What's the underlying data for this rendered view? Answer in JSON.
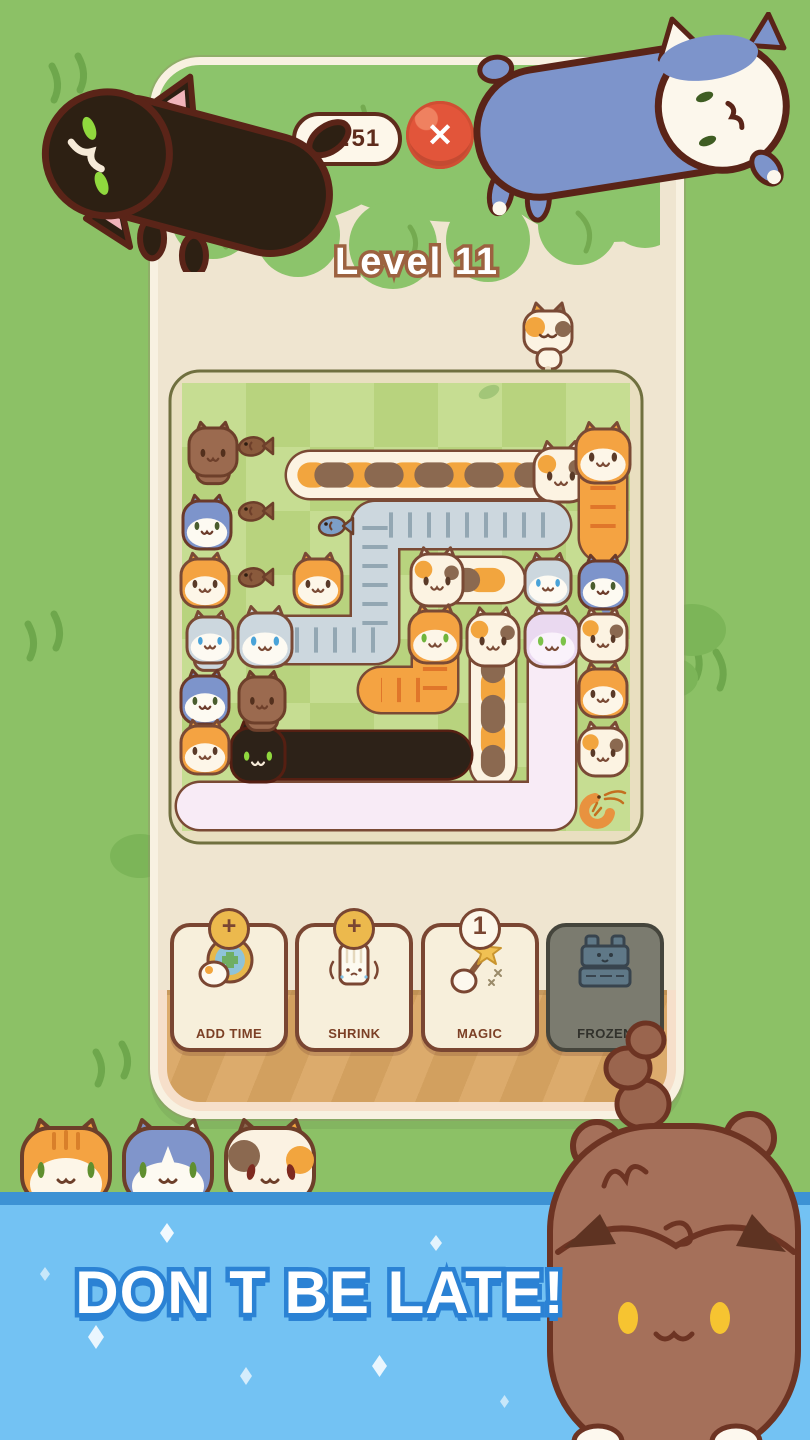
{
  "hud": {
    "timer": "00:51",
    "close": "✕",
    "level": "Level 11"
  },
  "powerups": [
    {
      "label": "ADD TIME",
      "badge": "+",
      "badge_type": "plus"
    },
    {
      "label": "SHRINK",
      "badge": "+",
      "badge_type": "plus"
    },
    {
      "label": "MAGIC",
      "badge": "1",
      "badge_type": "count"
    },
    {
      "label": "FROZEN",
      "badge": "",
      "badge_type": "none"
    }
  ],
  "banner": {
    "text": "DON T BE LATE!"
  },
  "colors": {
    "background": "#8cc166",
    "banner": "#73c2f3",
    "banner_stripe": "#3d92d4",
    "wall": "#efe5d0",
    "wood": "#dcab6c",
    "close_red": "#e2553a",
    "timer_brown": "#5e2c1c",
    "level_outline": "#9c6240",
    "banner_text_outline": "#2b82d4"
  },
  "board": {
    "grid": {
      "cols": 7,
      "rows": 7,
      "cell": 64,
      "origin": 15,
      "light": "#c6dd92",
      "dark": "#b8d37e",
      "frame": "#e9dfc0",
      "frame_edge": "#70703f"
    },
    "palettes": {
      "calico": {
        "base": "#fcf3e2",
        "face": "",
        "patch": [
          "#f2a53e",
          "#8b6950"
        ],
        "eye": "#5a3a28",
        "outline": "#7a4a35",
        "pattern": "spots",
        "spots": true
      },
      "gray": {
        "base": "#ccd7de",
        "face": "#fdfaf2",
        "patch": [
          "#93a7b3"
        ],
        "eye": "#4aa3d8",
        "outline": "#7a4a35",
        "pattern": "ticks"
      },
      "orange": {
        "base": "#f4a342",
        "face": "#fdf6e8",
        "patch": [
          "#e0762a"
        ],
        "eye": "#5a3a28",
        "outline": "#7a4a35",
        "pattern": "ticks"
      },
      "orangeG": {
        "base": "#f4a342",
        "face": "#fdf6e8",
        "patch": [
          "#e0762a"
        ],
        "eye": "#6fb43c",
        "outline": "#7a4a35",
        "pattern": "ticks"
      },
      "husky": {
        "base": "#7d94cb",
        "face": "#fdfaf2",
        "patch": [],
        "eye": "#4a5d2f",
        "outline": "#6b3a2a"
      },
      "brown": {
        "base": "#9b6a4f",
        "face": "",
        "patch": [],
        "eye": "#53301d",
        "outline": "#6d3f2a"
      },
      "black": {
        "base": "#2d2218",
        "face": "",
        "patch": [],
        "eye": "#90d83e",
        "outline": "#551f12"
      },
      "lav": {
        "base": "#ead9f0",
        "face": "#faf2fb",
        "patch": [],
        "eye": "#7cc24a",
        "outline": "#7a4a35",
        "bodyBase": "#f8ebf6"
      }
    },
    "snakes": [
      {
        "name": "calico-long-cat",
        "pal": "calico",
        "w": 46,
        "pts": [
          [
            143,
            107
          ],
          [
            394,
            107
          ]
        ],
        "head": [
          394,
          107
        ]
      },
      {
        "name": "gray-striped-long-cat",
        "pal": "gray",
        "w": 46,
        "pts": [
          [
            98,
            272
          ],
          [
            208,
            272
          ],
          [
            208,
            157
          ],
          [
            380,
            157
          ]
        ],
        "head": [
          98,
          272
        ]
      },
      {
        "name": "orange-long-cat-vertical",
        "pal": "orange",
        "w": 46,
        "pts": [
          [
            436,
            88
          ],
          [
            436,
            170
          ]
        ],
        "head": [
          436,
          88
        ]
      },
      {
        "name": "calico-long-cat-2",
        "pal": "calico",
        "w": 44,
        "pts": [
          [
            270,
            212
          ],
          [
            335,
            212
          ]
        ],
        "head": [
          270,
          212
        ]
      },
      {
        "name": "orange-long-cat-l",
        "pal": "orangeG",
        "w": 44,
        "pts": [
          [
            268,
            269
          ],
          [
            268,
            322
          ],
          [
            214,
            322
          ]
        ],
        "head": [
          268,
          269
        ]
      },
      {
        "name": "calico-long-cat-vertical",
        "pal": "calico",
        "w": 44,
        "pts": [
          [
            326,
            272
          ],
          [
            326,
            397
          ]
        ],
        "head": [
          326,
          272
        ]
      },
      {
        "name": "pink-long-cat",
        "pal": "lav",
        "w": 46,
        "pts": [
          [
            385,
            272
          ],
          [
            385,
            438
          ],
          [
            33,
            438
          ]
        ],
        "head": [
          385,
          272
        ]
      },
      {
        "name": "black-long-cat-board",
        "pal": "black",
        "w": 46,
        "pts": [
          [
            91,
            387
          ],
          [
            281,
            387
          ]
        ],
        "head": [
          91,
          387
        ]
      }
    ],
    "heads": [
      {
        "name": "brown-cat",
        "pal": "brown",
        "x": 46,
        "y": 84,
        "s": 48,
        "body": true
      },
      {
        "name": "husky-cat-1",
        "pal": "husky",
        "x": 40,
        "y": 157,
        "s": 48
      },
      {
        "name": "orange-cat-1",
        "pal": "orange",
        "x": 38,
        "y": 215,
        "s": 48
      },
      {
        "name": "orange-cat-2",
        "pal": "orange",
        "x": 151,
        "y": 215,
        "s": 48
      },
      {
        "name": "gray-cat-small",
        "pal": "gray",
        "x": 43,
        "y": 272,
        "s": 46,
        "body": true
      },
      {
        "name": "husky-cat-2",
        "pal": "husky",
        "x": 38,
        "y": 332,
        "s": 48
      },
      {
        "name": "brown-cat-2",
        "pal": "brown",
        "x": 95,
        "y": 332,
        "s": 46,
        "body": true
      },
      {
        "name": "orange-cat-3",
        "pal": "orange",
        "x": 38,
        "y": 382,
        "s": 48
      },
      {
        "name": "gray-cat-2",
        "pal": "gray",
        "x": 381,
        "y": 214,
        "s": 46
      },
      {
        "name": "blue-cat-vertical",
        "pal": "husky",
        "x": 436,
        "y": 217,
        "s": 48,
        "tail": true
      },
      {
        "name": "calico-cat-right-1",
        "pal": "calico",
        "x": 436,
        "y": 270,
        "s": 48
      },
      {
        "name": "orange-cat-right",
        "pal": "orange",
        "x": 436,
        "y": 325,
        "s": 48
      },
      {
        "name": "calico-cat-right-2",
        "pal": "calico",
        "x": 436,
        "y": 384,
        "s": 48
      }
    ],
    "snacks": [
      {
        "name": "fish-snack-1",
        "type": "fish",
        "color": "#8a5a3c",
        "x": 88,
        "y": 78
      },
      {
        "name": "fish-snack-2",
        "type": "fish",
        "color": "#8a5a3c",
        "x": 88,
        "y": 143
      },
      {
        "name": "fish-snack-3",
        "type": "fish",
        "color": "#8a5a3c",
        "x": 88,
        "y": 209
      },
      {
        "name": "blue-fish-snack",
        "type": "fish",
        "color": "#7d9fc7",
        "x": 168,
        "y": 158
      },
      {
        "name": "shrimp-snack",
        "type": "shrimp",
        "color": "#e8923f",
        "x": 436,
        "y": 440
      }
    ]
  }
}
